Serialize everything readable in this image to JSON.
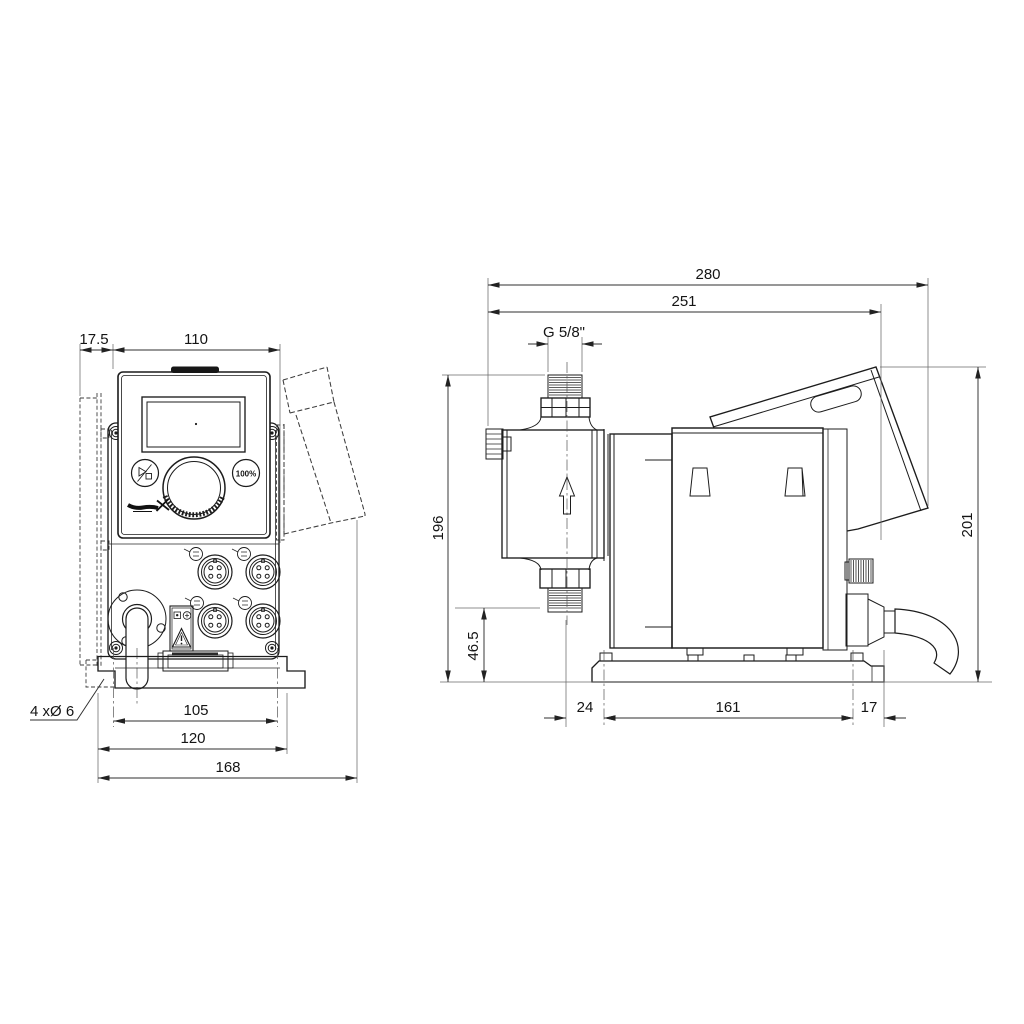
{
  "drawing_type": "dimensional drawing, dosing pump, front and side view",
  "front_view": {
    "dims": {
      "wall_offset": "17.5",
      "panel_width": "110",
      "mounting_holes": "4 xØ 6",
      "hole_spacing": "105",
      "bracket_width": "120",
      "overall_width": "168"
    },
    "panel": {
      "full_capacity_button": "100%"
    }
  },
  "side_view": {
    "dims": {
      "overall_depth": "280",
      "mounting_depth": "251",
      "connection_thread": "G 5/8\"",
      "height_to_connection": "196",
      "height_to_suction": "46.5",
      "overall_height": "201",
      "front_offset": "24",
      "base_length": "161",
      "rear_offset": "17"
    }
  },
  "icons": {
    "start_stop": "play-stop-icon",
    "logo": "grundfos-logo",
    "warning": "warning-triangle-icon",
    "flow_direction": "flow-arrow-up-icon"
  },
  "colors": {
    "line": "#1c1c1c",
    "dimension": "#2f2f2f",
    "background": "#ffffff"
  }
}
